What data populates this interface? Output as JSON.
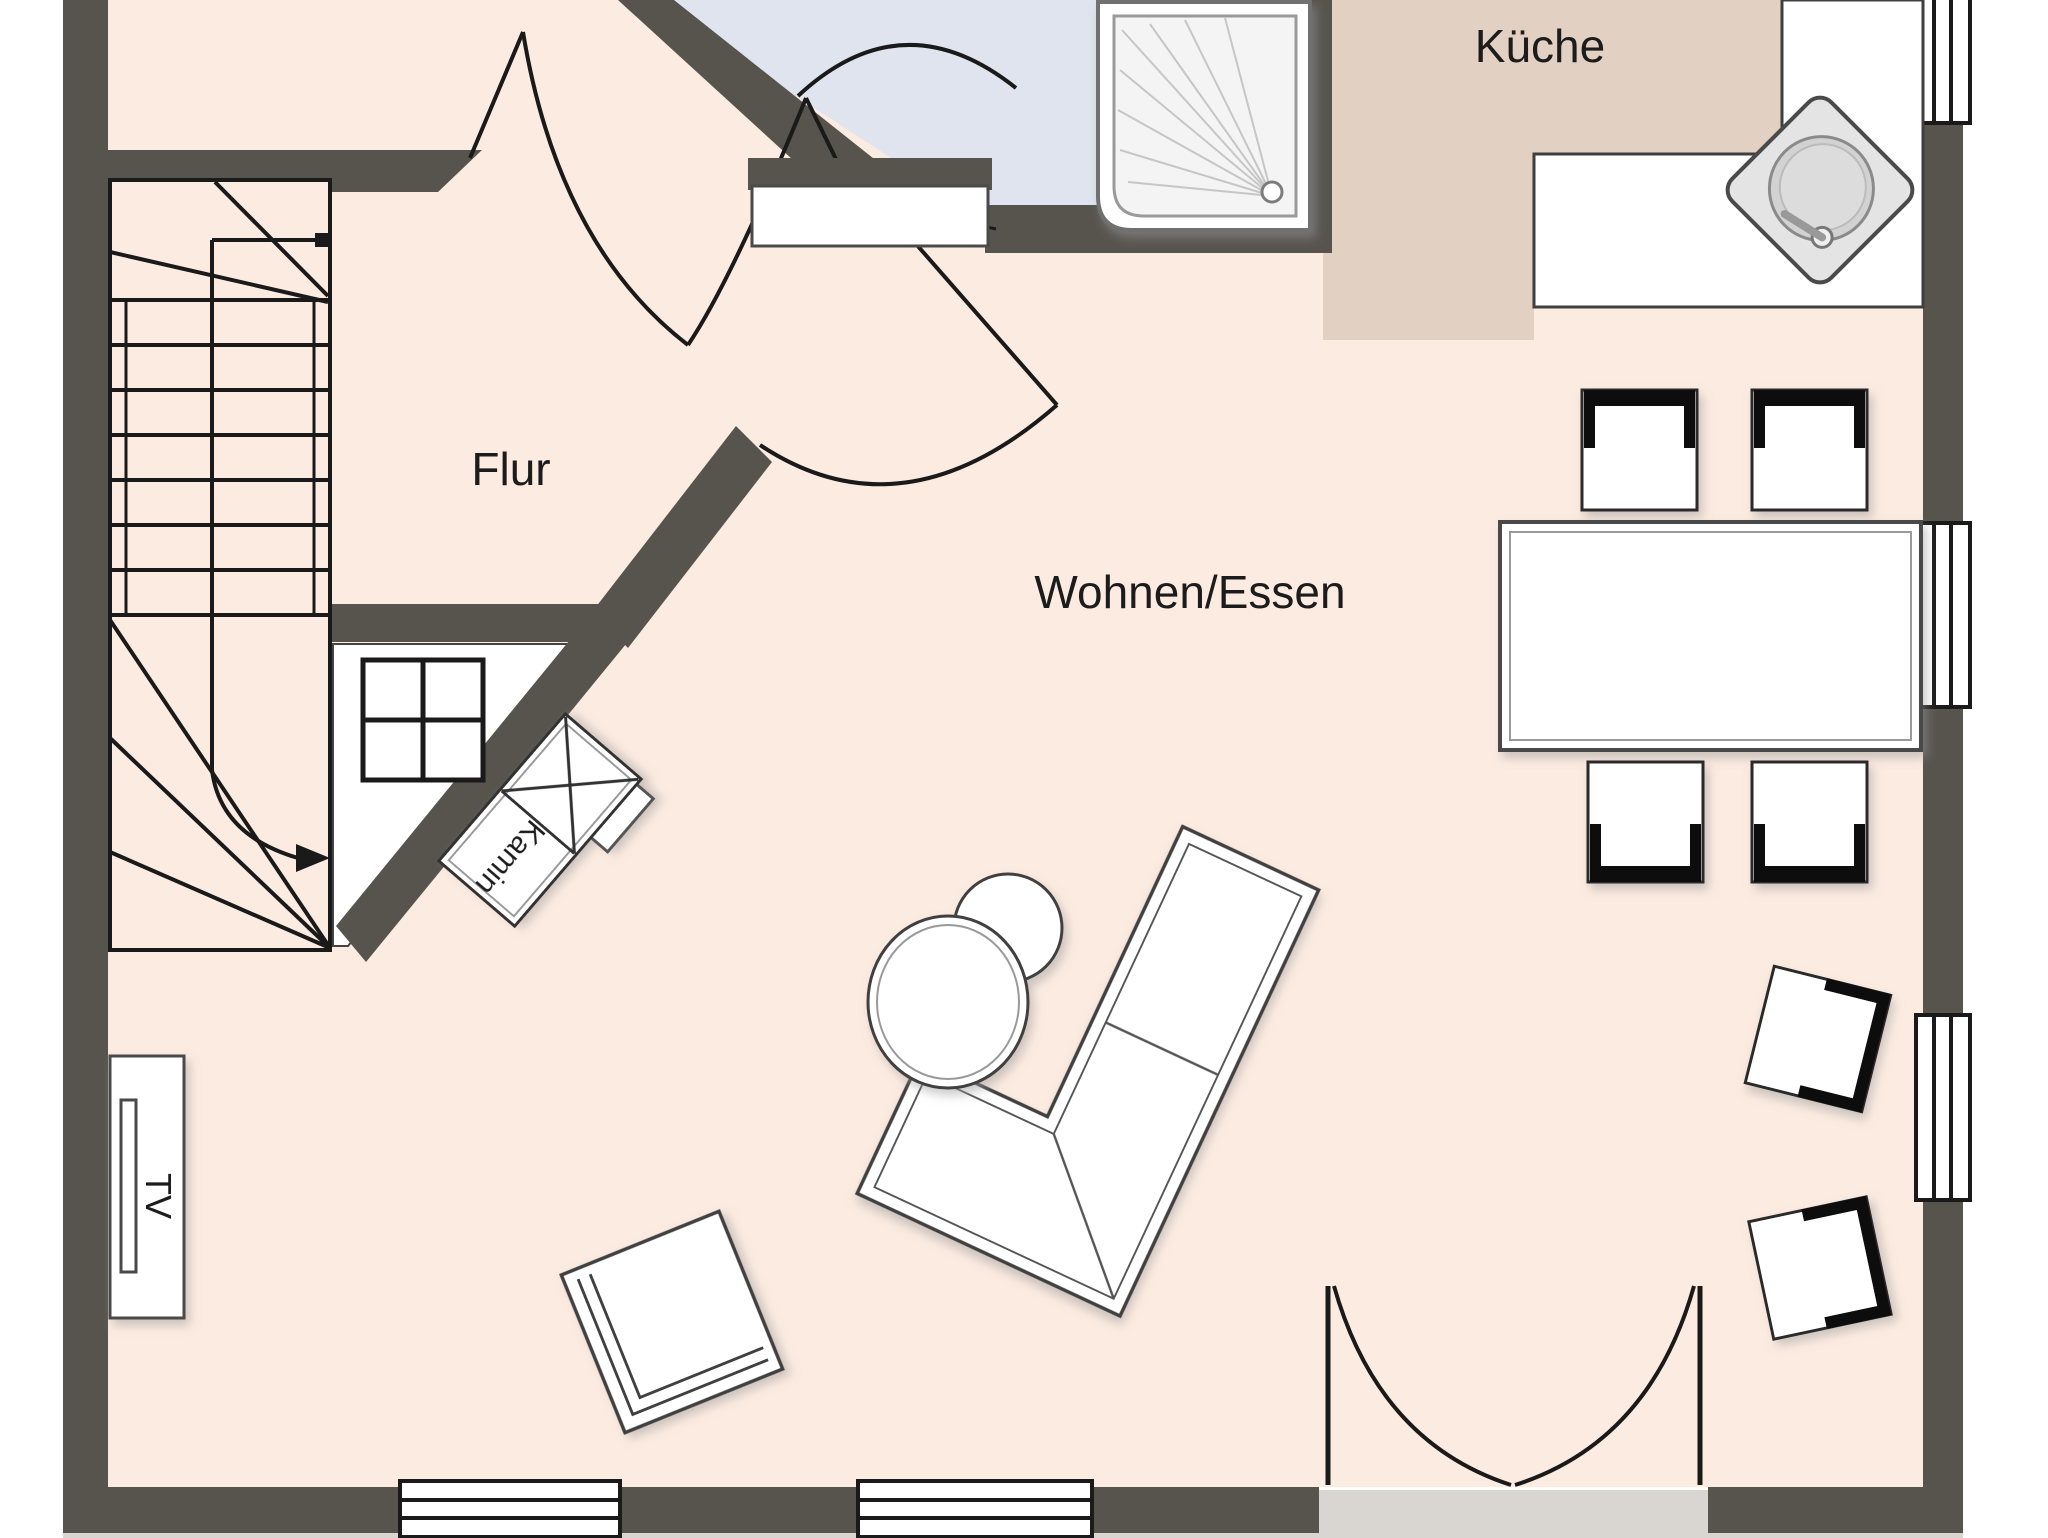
{
  "floorplan": {
    "labels": {
      "hallway": "Flur",
      "kitchen": "Küche",
      "living_dining": "Wohnen/Essen",
      "fireplace": "Kamin",
      "tv": "TV"
    },
    "colors": {
      "wall": "#57544e",
      "floor_main": "#fcebe0",
      "floor_kitchen": "#e2d1c2",
      "floor_bath": "#dfe4ee",
      "floor_utility": "#ffffff",
      "terrace": "#d9d5d0",
      "line": "#1a1a1a",
      "furniture_fill": "#ffffff",
      "furniture_stroke": "#4a4a4a"
    }
  }
}
